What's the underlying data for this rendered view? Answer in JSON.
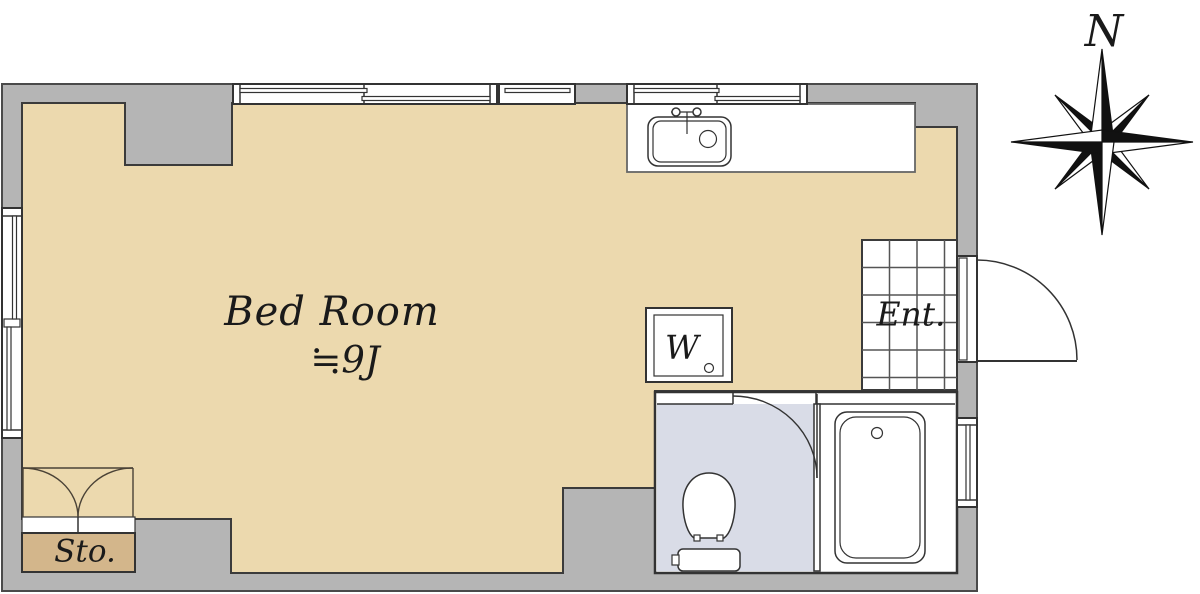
{
  "labels": {
    "bedroom": "Bed Room",
    "bedroom_size": "≒9J",
    "entrance": "Ent.",
    "storage": "Sto.",
    "washer": "W",
    "compass_north": "N"
  },
  "floorplan": {
    "rooms": [
      {
        "name": "bedroom",
        "label": "Bed Room",
        "size": "≒9J"
      },
      {
        "name": "entrance",
        "label": "Ent.",
        "floor": "tile-grid"
      },
      {
        "name": "storage",
        "label": "Sto."
      },
      {
        "name": "toilet-room"
      },
      {
        "name": "bath-room"
      }
    ],
    "fixtures": [
      "kitchen-sink",
      "washing-machine",
      "toilet",
      "bathtub"
    ],
    "doors": [
      "entry-swing-door",
      "bathroom-swing-door",
      "storage-double-doors"
    ],
    "compass": {
      "label": "N",
      "direction": "north"
    }
  },
  "colors": {
    "wall": "#b5b5b5",
    "floor": "#ecd9ae",
    "storage_floor": "#d3b68b",
    "bathroom_floor": "#d9dce7",
    "fixture": "#ffffff",
    "outline": "#333333"
  }
}
